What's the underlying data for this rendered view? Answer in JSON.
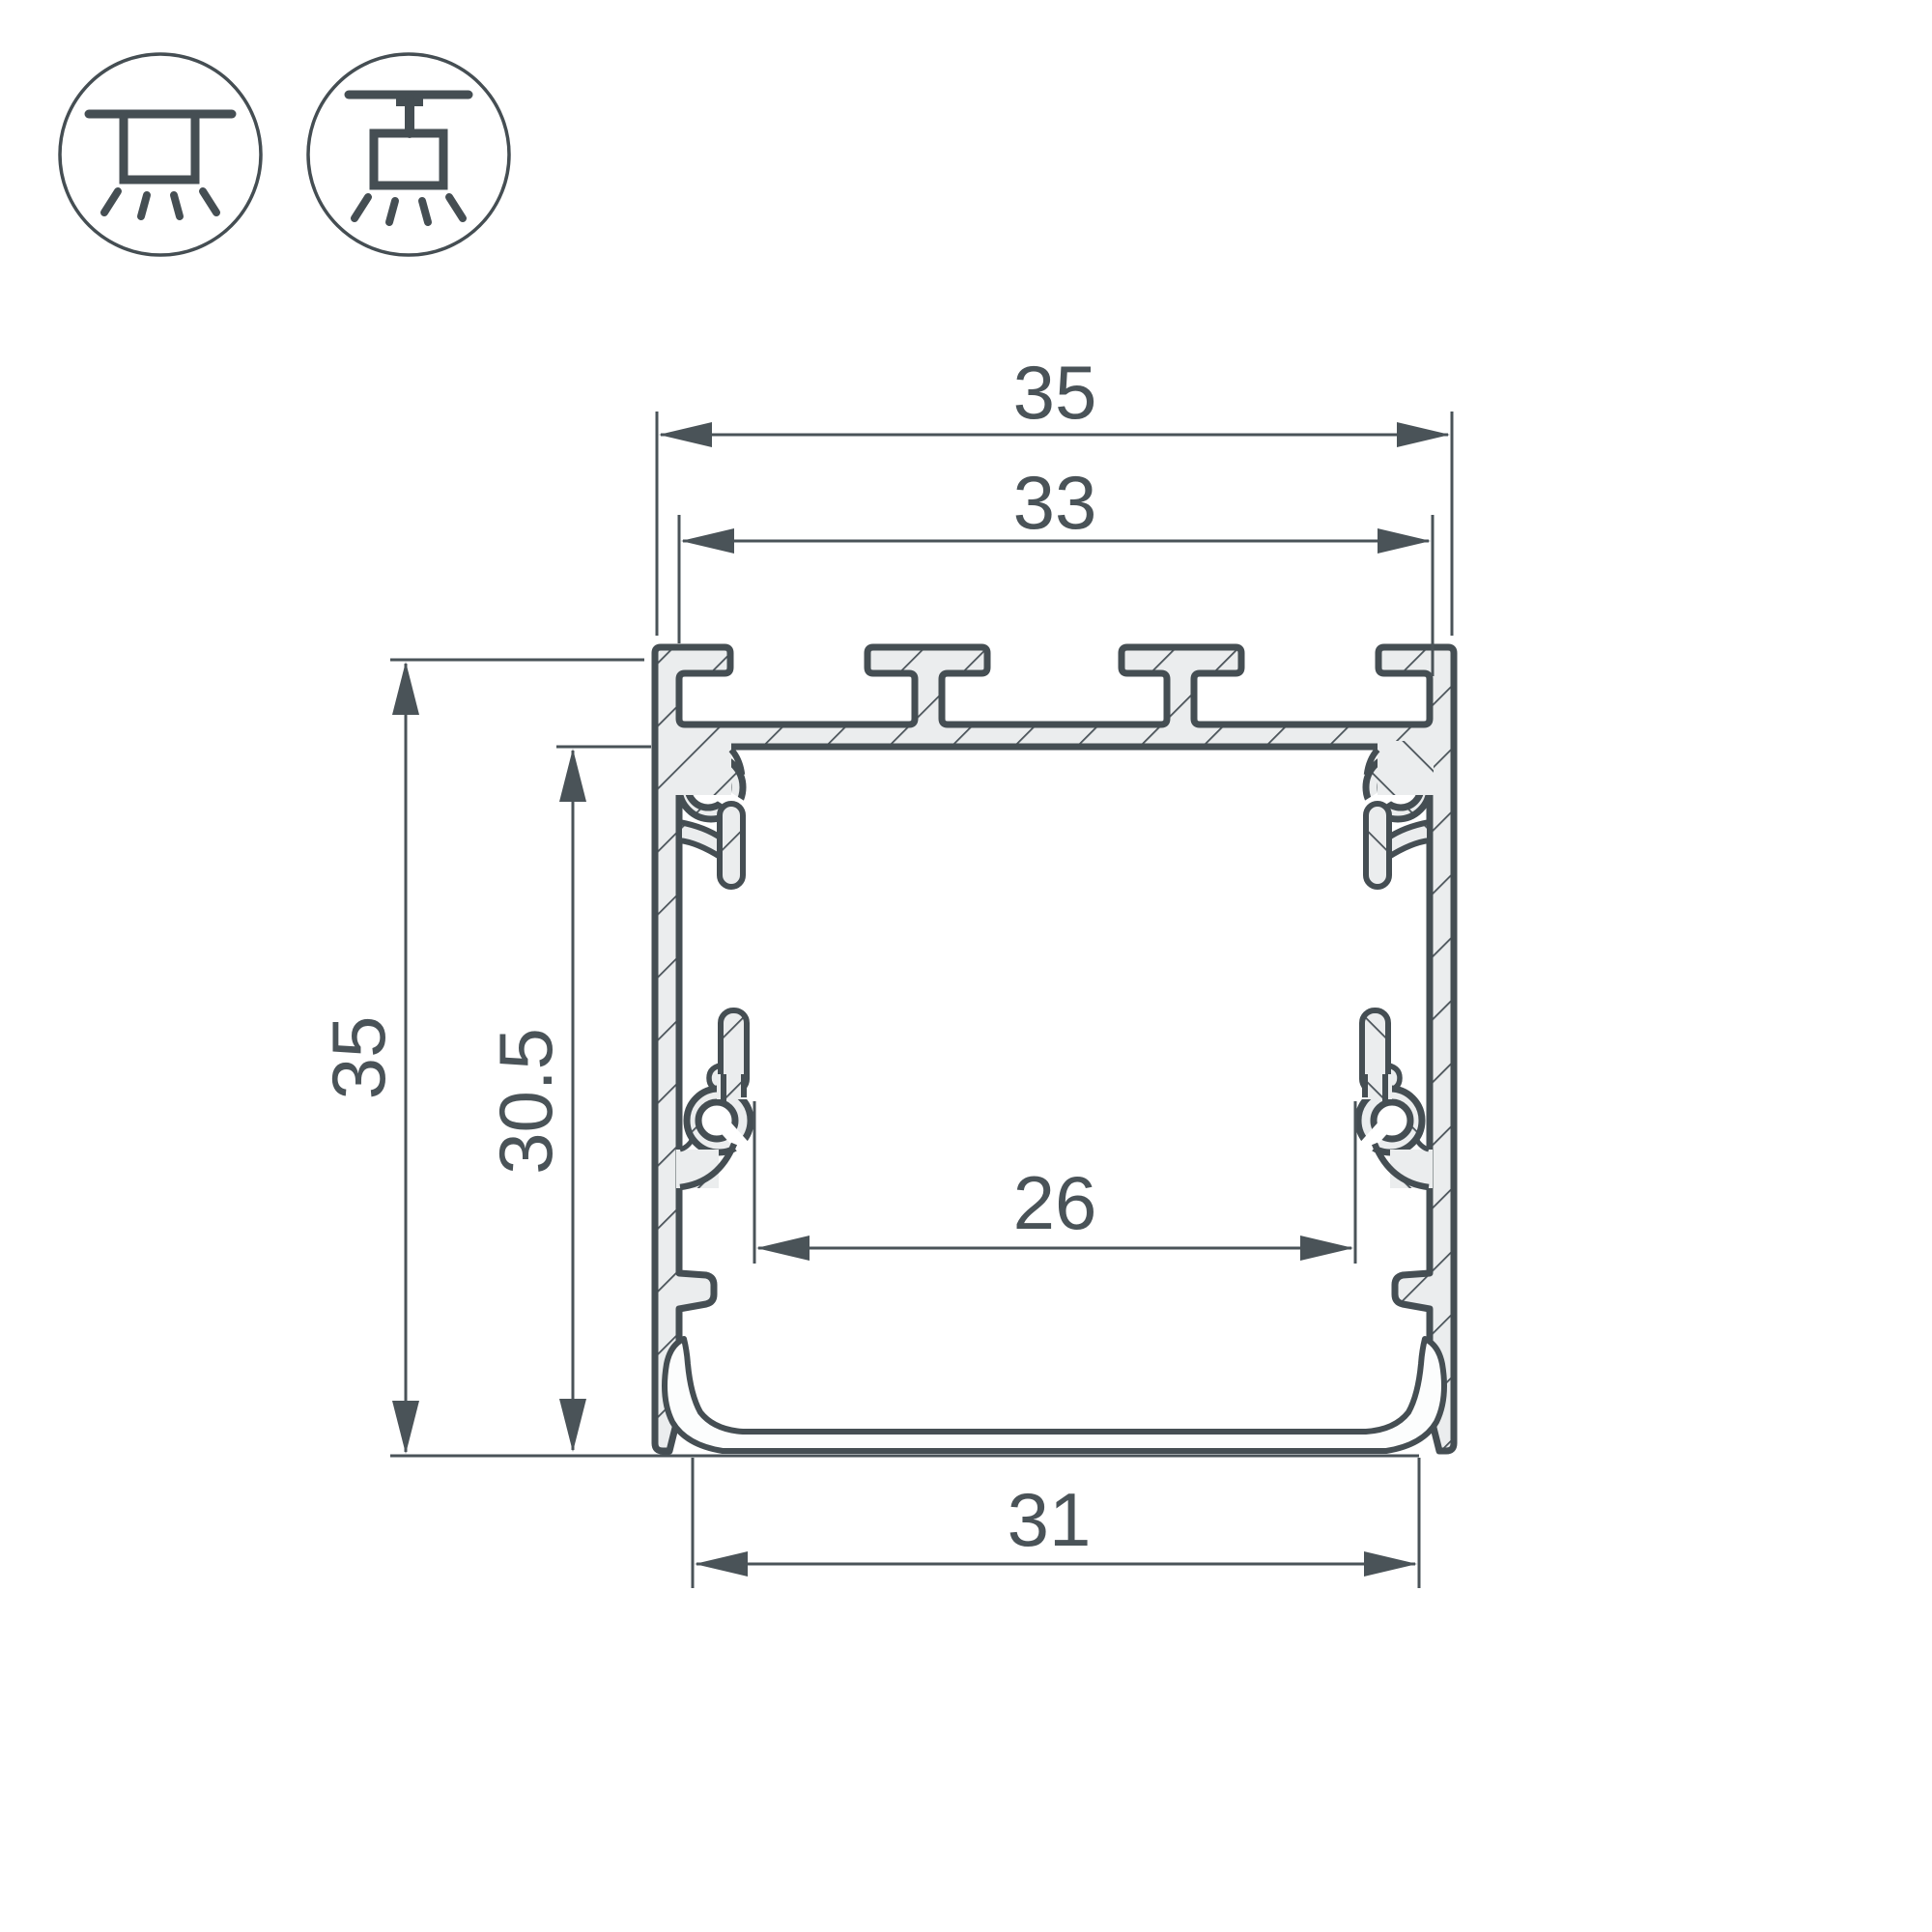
{
  "drawing": {
    "title": "led-profile-cross-section",
    "dimension_labels": {
      "top_width": "35",
      "inner_top_width": "33",
      "overall_height": "35",
      "inner_height": "30.5",
      "inner_bottom_width": "26",
      "bottom_width": "31"
    },
    "icons": [
      {
        "name": "surface-mounted-luminaire-icon"
      },
      {
        "name": "suspended-luminaire-icon"
      }
    ],
    "colors": {
      "line": "#454e53",
      "metal_fill": "#ebedee",
      "hatch_line": "#4b545a",
      "diffuser_fill": "#fcfdfd",
      "background": "#ffffff"
    }
  }
}
